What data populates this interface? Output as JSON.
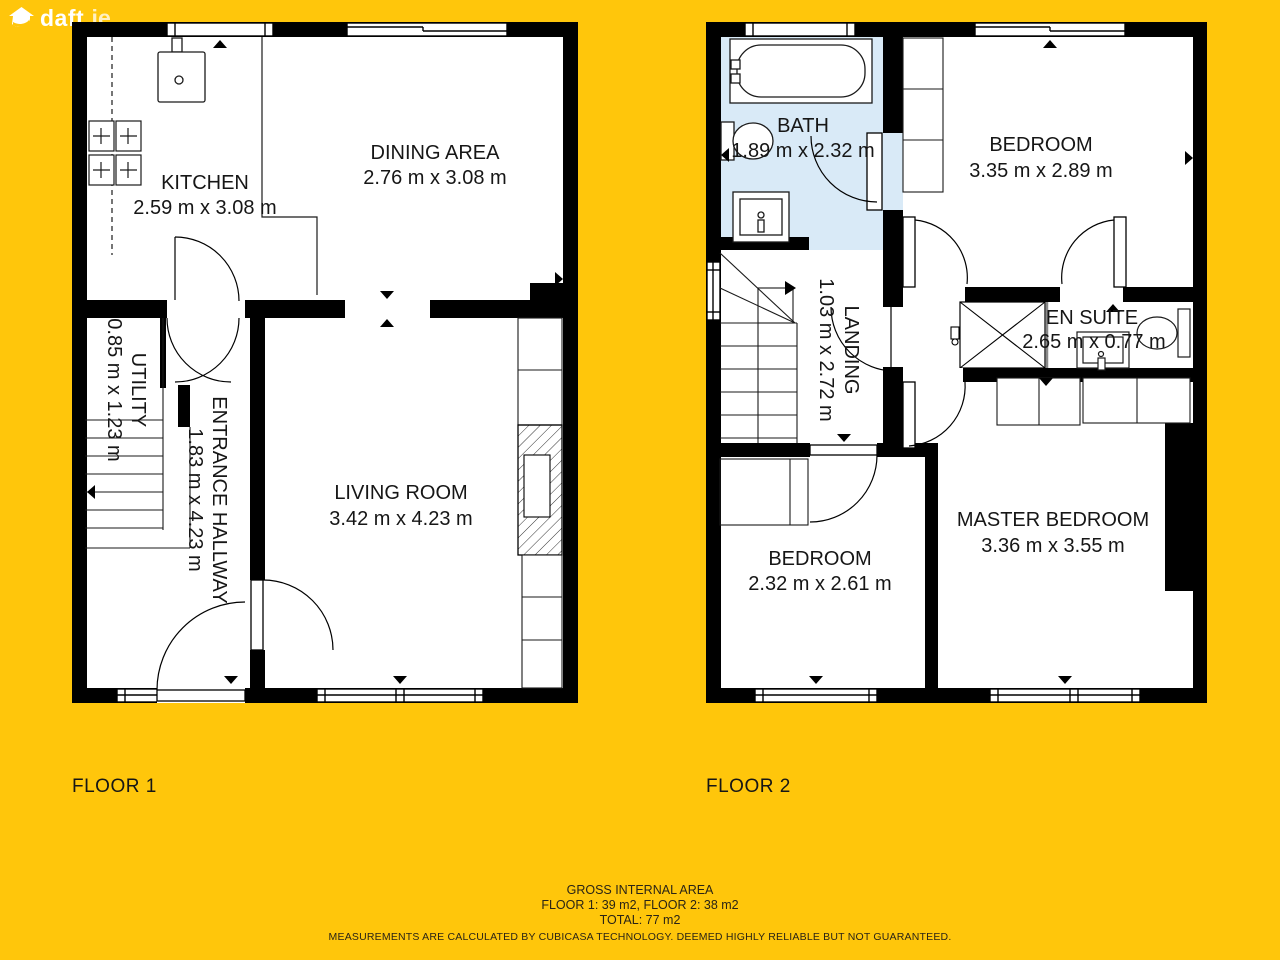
{
  "logo": {
    "brand": "daft",
    "tld": ".ie"
  },
  "floor1": {
    "label": "FLOOR 1",
    "rooms": {
      "kitchen": {
        "name": "KITCHEN",
        "dims": "2.59 m x 3.08 m"
      },
      "dining": {
        "name": "DINING AREA",
        "dims": "2.76 m x 3.08 m"
      },
      "utility": {
        "name": "UTILITY",
        "dims": "0.85 m x 1.23 m"
      },
      "hallway": {
        "name": "ENTRANCE HALLWAY",
        "dims": "1.83 m x 4.23 m"
      },
      "living": {
        "name": "LIVING ROOM",
        "dims": "3.42 m x 4.23 m"
      }
    }
  },
  "floor2": {
    "label": "FLOOR 2",
    "rooms": {
      "bath": {
        "name": "BATH",
        "dims": "1.89 m x 2.32 m"
      },
      "bedroom1": {
        "name": "BEDROOM",
        "dims": "3.35 m x 2.89 m"
      },
      "landing": {
        "name": "LANDING",
        "dims": "1.03 m x 2.72 m"
      },
      "ensuite": {
        "name": "EN SUITE",
        "dims": "2.65 m x 0.77 m"
      },
      "bedroom2": {
        "name": "BEDROOM",
        "dims": "2.32 m x 2.61 m"
      },
      "master": {
        "name": "MASTER BEDROOM",
        "dims": "3.36 m x 3.55 m"
      }
    }
  },
  "footer": {
    "line1": "GROSS INTERNAL AREA",
    "line2": "FLOOR 1: 39 m2, FLOOR 2: 38 m2",
    "line3": "TOTAL: 77 m2",
    "disclaimer": "MEASUREMENTS ARE CALCULATED BY CUBICASA TECHNOLOGY. DEEMED HIGHLY RELIABLE BUT NOT GUARANTEED."
  },
  "colors": {
    "background": "#FFC60B",
    "wall": "#000000",
    "room_fill": "#FFFFFF",
    "bath_fill": "#D9EAF7"
  }
}
